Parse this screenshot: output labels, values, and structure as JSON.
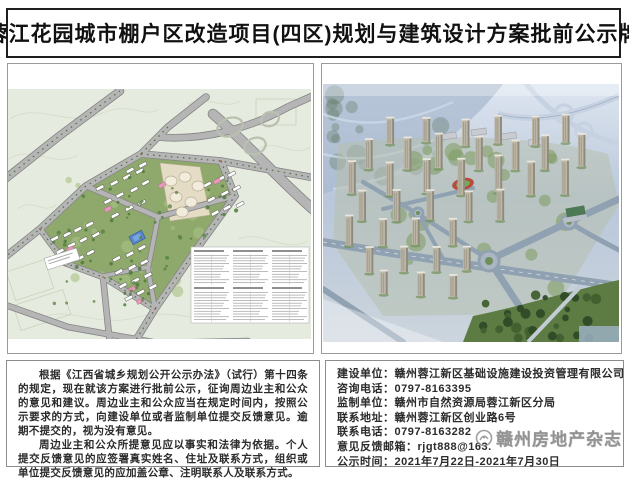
{
  "page": {
    "title": "蓉江花园城市棚户区改造项目(四区)规划与建筑设计方案批前公示牌"
  },
  "images": {
    "site_plan_name": "site-plan-drawing",
    "rendering_name": "aerial-rendering"
  },
  "notice": {
    "paragraph1": "根据《江西省城乡规划公开公示办法》（试行）第十四条的规定，现在就该方案进行批前公示，征询周边业主和公众的意见和建议。周边业主和公众应当在规定时间内，按照公示要求的方式，向建设单位或者监制单位提交反馈意见。逾期不提交的，视为没有意见。",
    "paragraph2": "周边业主和公众所提意见应以事实和法律为依据。个人提交反馈意见的应签署真实姓名、住址及联系方式，组织或单位提交反馈意见的应加盖公章、注明联系人及联系方式。"
  },
  "contact": {
    "lines": [
      {
        "label": "建设单位：",
        "value": "赣州蓉江新区基础设施建设投资管理有限公司"
      },
      {
        "label": "咨询电话：",
        "value": "0797-8163395"
      },
      {
        "label": "监制单位：",
        "value": "赣州市自然资源局蓉江新区分局"
      },
      {
        "label": "联系地址：",
        "value": "赣州蓉江新区创业路6号"
      },
      {
        "label": "联系电话：",
        "value": "0797-8163282"
      },
      {
        "label": "意见反馈邮箱：",
        "value": "rjgt888@163."
      },
      {
        "label": "公示时间：",
        "value": "2021年7月22日-2021年7月30日"
      }
    ]
  },
  "watermark": {
    "text": "赣州房地产杂志"
  },
  "colors": {
    "title_border": "#1e1e1e",
    "panel_border": "#9a9a9a",
    "map_background": "#e6ebdf",
    "map_road": "#b5b5b5",
    "site_green": "#8fa96c",
    "accent_pink": "#e39ab8",
    "civic_blue": "#5a87c9",
    "sky_haze": "#c3d0e2",
    "forest_green": "#5d7c44",
    "watermark_gray": "#7c7c7c"
  }
}
